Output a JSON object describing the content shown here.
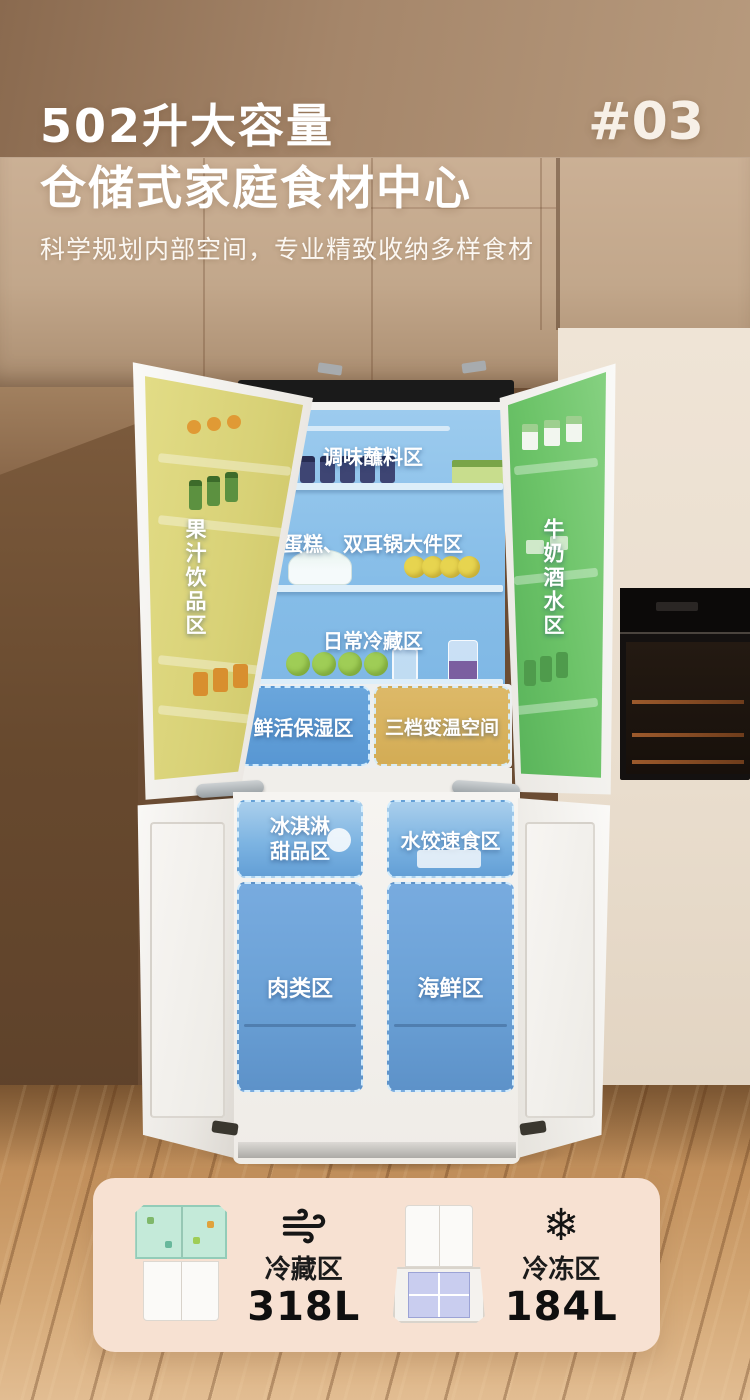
{
  "header": {
    "title_line1": "502升大容量",
    "title_line2": "仓储式家庭食材中心",
    "index_badge": "#03",
    "subtitle": "科学规划内部空间，专业精致收纳多样食材"
  },
  "fridge_zones": {
    "fridge_section": {
      "left_door": "果汁饮品区",
      "right_door": "牛奶酒水区",
      "top_shelf": "调味蘸料区",
      "middle_shelf": "蛋糕、双耳锅大件区",
      "lower_shelf": "日常冷藏区",
      "humidity_drawer": "鲜活保湿区",
      "variable_temp_drawer": "三档变温空间"
    },
    "freezer_section": {
      "ice_cream_drawer_lines": [
        "冰淇淋",
        "甜品区"
      ],
      "dumpling_drawer": "水饺速食区",
      "meat_drawer": "肉类区",
      "seafood_drawer": "海鲜区"
    }
  },
  "summary_card": {
    "cold_zone": {
      "label": "冷藏区",
      "capacity": "318L",
      "icon": "wind-icon"
    },
    "freezer_zone": {
      "label": "冷冻区",
      "capacity": "184L",
      "icon": "snowflake-icon",
      "glyph": "❄"
    }
  },
  "colors": {
    "zone_blue": "#5d9ed8",
    "zone_gold": "#d9b45f",
    "zone_yellow": "#d9d377",
    "zone_green": "#6fc66c",
    "card_bg": "#f7e1d2",
    "title_text": "#ffffff",
    "capacity_text": "#0f0f0f"
  }
}
